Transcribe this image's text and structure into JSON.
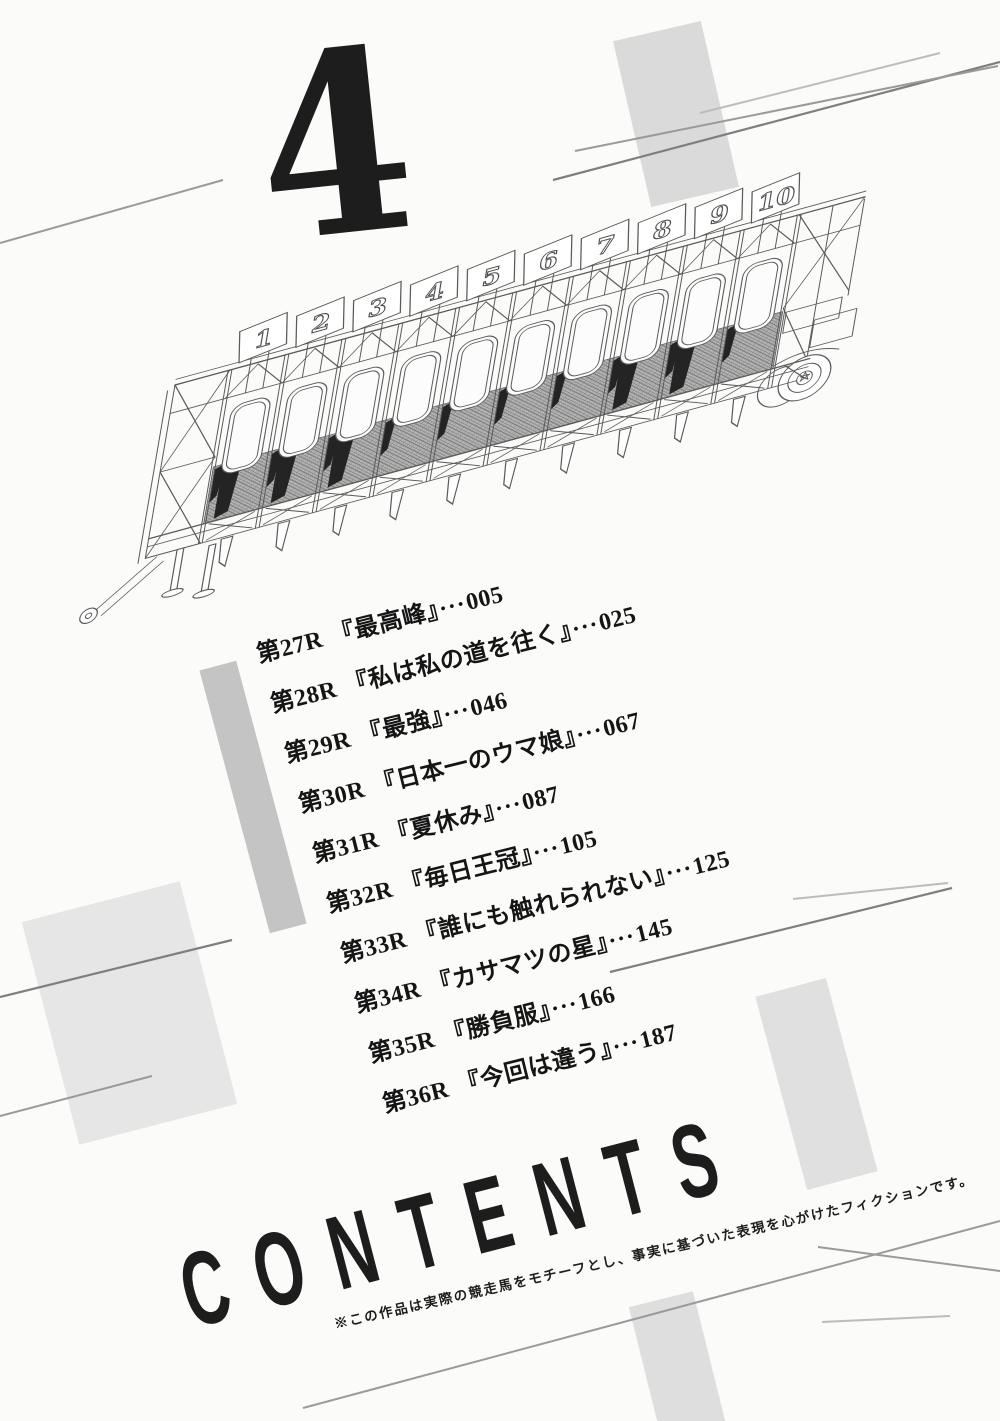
{
  "page": {
    "volume_number": "4",
    "title": "CONTENTS",
    "disclaimer": "※この作品は実際の競走馬をモチーフとし、事実に基づいた表現を心がけたフィクションです。"
  },
  "toc": {
    "chapters": [
      {
        "label": "第27R",
        "title": "『最高峰』",
        "leader": "···",
        "page": "005"
      },
      {
        "label": "第28R",
        "title": "『私は私の道を往く』",
        "leader": "···",
        "page": "025"
      },
      {
        "label": "第29R",
        "title": "『最強』",
        "leader": "···",
        "page": "046"
      },
      {
        "label": "第30R",
        "title": "『日本一のウマ娘』",
        "leader": "···",
        "page": "067"
      },
      {
        "label": "第31R",
        "title": "『夏休み』",
        "leader": "···",
        "page": "087"
      },
      {
        "label": "第32R",
        "title": "『毎日王冠』",
        "leader": "···",
        "page": "105"
      },
      {
        "label": "第33R",
        "title": "『誰にも触れられない』",
        "leader": "···",
        "page": "125"
      },
      {
        "label": "第34R",
        "title": "『カサマツの星』",
        "leader": "···",
        "page": "145"
      },
      {
        "label": "第35R",
        "title": "『勝負服』",
        "leader": "···",
        "page": "166"
      },
      {
        "label": "第36R",
        "title": "『今回は違う』",
        "leader": "···",
        "page": "187"
      }
    ]
  },
  "illustration": {
    "name": "horse-racing-starting-gate",
    "stall_numbers": [
      "1",
      "2",
      "3",
      "4",
      "5",
      "6",
      "7",
      "8",
      "9",
      "10"
    ]
  },
  "colors": {
    "paper": "#fbfbfa",
    "ink": "#1d1d1d",
    "line_art": "#5a5a5a",
    "accent_dark": "#7f7f7f",
    "accent_mid": "#9a9a9a",
    "accent_light": "#bcbcbc",
    "bar_gray": "#dadada",
    "bar_gray_dark": "#c4c4c4",
    "mesh_fill": "#b7b7b7"
  }
}
